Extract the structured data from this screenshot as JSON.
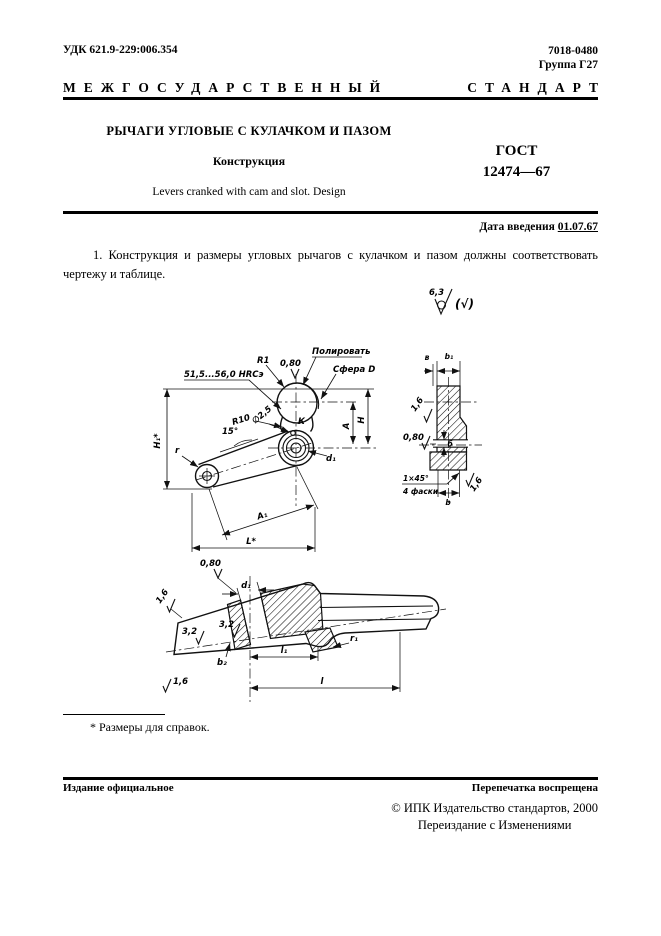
{
  "header": {
    "udk": "УДК 621.9-229:006.354",
    "code": "7018-0480",
    "group": "Группа Г27",
    "standard_word1": "МЕЖГОСУДАРСТВЕННЫЙ",
    "standard_word2": "СТАНДАРТ"
  },
  "title": {
    "main": "РЫЧАГИ УГЛОВЫЕ С КУЛАЧКОМ И ПАЗОМ",
    "sub": "Конструкция",
    "translation": "Levers cranked with cam and slot. Design",
    "gost_label": "ГОСТ",
    "gost_number": "12474—67"
  },
  "intro": {
    "date_label": "Дата введения",
    "date_value": "01.07.67",
    "paragraph": "1. Конструкция и размеры угловых рычагов с кулачком и пазом должны соответствовать чертежу и таблице."
  },
  "roughness_general": {
    "value": "6,3",
    "suffix": "(√)"
  },
  "drawing": {
    "main": {
      "hardness": "51,5...56,0 HRCэ",
      "r1": "R1",
      "rough_top": "0,80",
      "polish": "Полировать",
      "sphere": "Сфера D",
      "r10": "R10",
      "dia": "∅2,5",
      "angle": "15°",
      "k": "К",
      "h1": "H₁*",
      "r": "r",
      "a1": "A₁",
      "l": "L*",
      "a": "A",
      "h": "H",
      "d1": "d₁"
    },
    "side": {
      "v": "в",
      "b1": "b₁",
      "rough_left": "1,6",
      "rough_slot": "0,80",
      "slot": "б",
      "chamfer": "1×45°",
      "chamfer_note": "4 фаски",
      "b": "b",
      "rough_right": "1,6"
    },
    "section": {
      "rough_top": "0,80",
      "d1": "d₁",
      "rough_ul": "1,6",
      "rough_f1": "3,2",
      "rough_f2": "3,2",
      "b2": "b₂",
      "rough_ll": "1,6",
      "l1": "l₁",
      "l": "l",
      "r1": "r₁"
    }
  },
  "footnote": "* Размеры для справок.",
  "footer": {
    "left": "Издание официальное",
    "right": "Перепечатка воспрещена",
    "copyright": "© ИПК Издательство стандартов, 2000",
    "reissue": "Переиздание с Изменениями"
  }
}
